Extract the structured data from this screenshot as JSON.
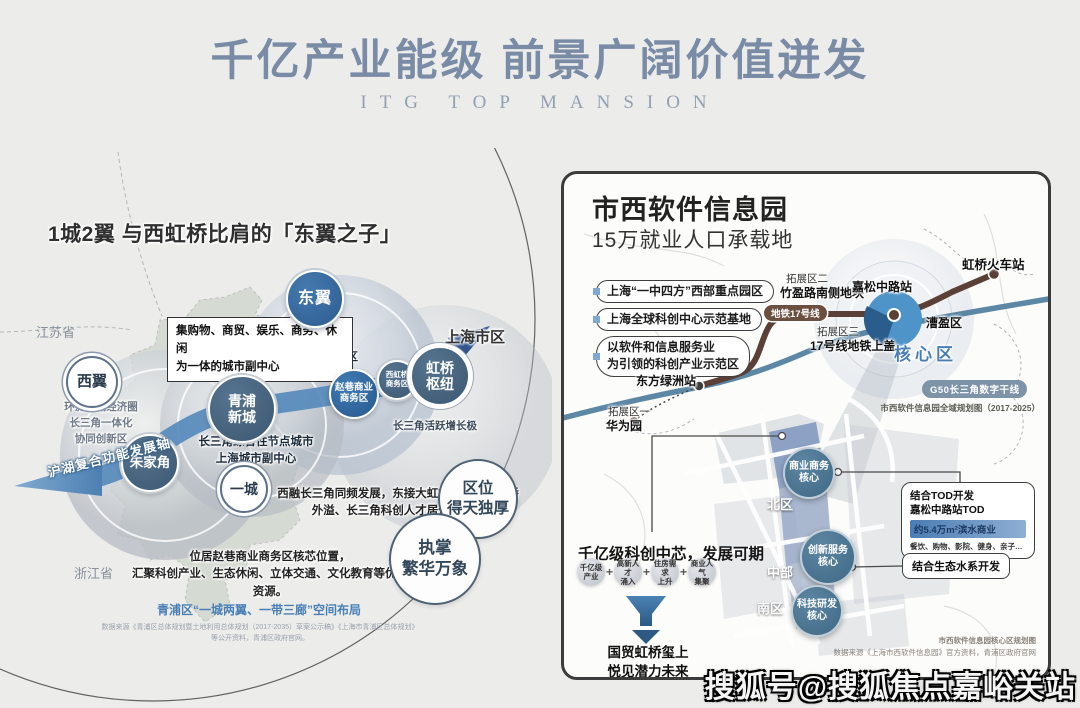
{
  "header": {
    "title": "千亿产业能级  前景广阔价值迸发",
    "subtitle": "ITG TOP MANSION"
  },
  "watermark": "搜狐号@搜狐焦点嘉峪关站",
  "colors": {
    "title_blue": "#7a8ba6",
    "band_blue": "#5488ba",
    "navy_arrow": "#33568e",
    "slate_circle": "#46627c",
    "bright_blue": "#2f6da8",
    "metro_brown": "#6b4f41",
    "river_blue": "#4e7e9e",
    "core_text_blue": "#4a7fb5",
    "g50_pill": "#7d93a8"
  },
  "left": {
    "title": "1城2翼 与西虹桥比肩的「东翼之子」",
    "jiangsu": "江苏省",
    "zhejiang": "浙江省",
    "callout": "集购物、商贸、娱乐、商务、休闲\n为一体的城市副中心",
    "dongyi": "东翼",
    "dongyi_desc": "国际一流的\n现代服务业集聚区",
    "xiyi": "西翼",
    "xiyi_desc": "环淀山湖经济圈\n长三角一体化\n协同创新区",
    "qingpu": "青浦\n新城",
    "qingpu_desc": "长三角综合性节点城市\n上海城市副中心",
    "zhujiajiao": "朱家角",
    "yicheng": "一城",
    "zhaoxiang": "赵巷商业\n商务区",
    "xihongqiao": "西虹桥\n商务区",
    "hongqiao": "虹桥\n枢纽",
    "shanghai": "上海市区",
    "growth_pole": "长三角活跃增长极",
    "axis": "沪湖复合功能发展轴",
    "desc_east": "西融长三角同频发展，东接大虹桥，将承接虹桥\n外溢、长三角科创人才居住需求。",
    "desc_core": "位居赵巷商业商务区核芯位置，\n汇聚科创产业、生态休闲、立体交通、文化教育等优质资源。",
    "badge_location": "区位\n得天独厚",
    "badge_prosper": "执掌\n繁华万象",
    "caption_blue": "青浦区“一城两翼、一带三廊”空间布局",
    "caption_small": "数据来源《青浦区总体规划暨土地利用总体规划（2017-2035）草案公示稿》《上海市青浦区总体规划》\n等公开资料，青浦区政府官网。"
  },
  "right": {
    "title": "市西软件信息园",
    "subtitle": "15万就业人口承载地",
    "pills": [
      "上海“一中四方”西部重点园区",
      "上海全球科创中心示范基地",
      "以软件和信息服务业\n为引领的科创产业示范区"
    ],
    "zone2": "拓展区二",
    "zone2_sub": "竹盈路南侧地块",
    "metro": "地铁17号线",
    "zone3": "拓展区三",
    "zone3_sub": "17号线地铁上盖",
    "station": "嘉松中路站",
    "caoying": "漕盈区",
    "core_area": "核心区",
    "hongqiao_rail": "虹桥火车站",
    "dongfang_station": "东方绿洲站",
    "zone1": "拓展区一",
    "zone1_sub": "华为园",
    "g50": "G50长三角数字干线",
    "map_caption": "市西软件信息园全域规划图（2017-2025）",
    "districts": {
      "north": "北区",
      "middle": "中部",
      "south": "南区"
    },
    "cores": {
      "business": "商业商务\n核心",
      "innovation": "创新服务\n核心",
      "tech": "科技研发\n核心"
    },
    "tod": {
      "line1": "结合TOD开发",
      "line2": "嘉松中路站TOD",
      "highlight": "约5.4万m²滨水商业",
      "detail": "餐饮、购物、影院、健身、亲子…"
    },
    "eco": "结合生态水系开发",
    "heading": "千亿级科创中芯，发展可期",
    "flow": [
      "千亿级\n产业",
      "高新人才\n涌入",
      "住房需求\n上升",
      "商业人气\n集聚"
    ],
    "plus": "+",
    "funnel_text": "国贸虹桥玺上\n悦见潜力未来",
    "caption1": "市西软件信息园核心区规划图",
    "caption2": "数据来源《上海市西软件信息园》官方资料，青浦区政府官网"
  }
}
